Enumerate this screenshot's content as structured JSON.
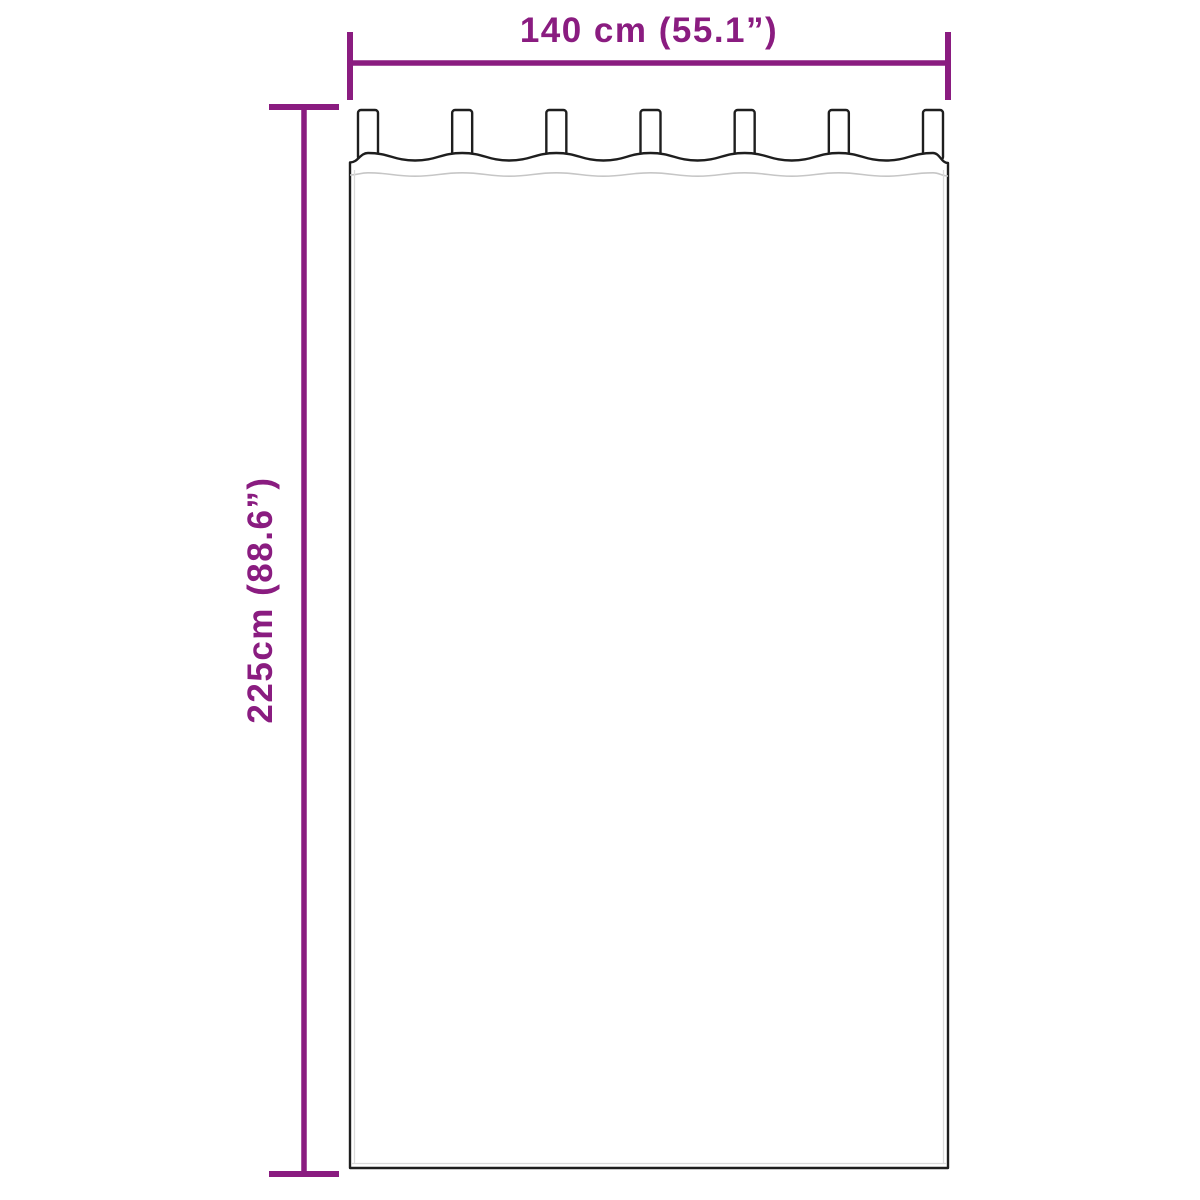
{
  "diagram": {
    "subject": "tab-top curtain dimension drawing",
    "width_label": "140 cm (55.1”)",
    "height_label": "225cm (88.6”)",
    "curtain": {
      "tab_count": 7
    },
    "colors": {
      "accent": "#8A1C80",
      "outline": "#1E1E1E",
      "seam": "#C6C6C6",
      "hem_shadow": "#DADADA",
      "background": "#FFFFFF"
    }
  }
}
